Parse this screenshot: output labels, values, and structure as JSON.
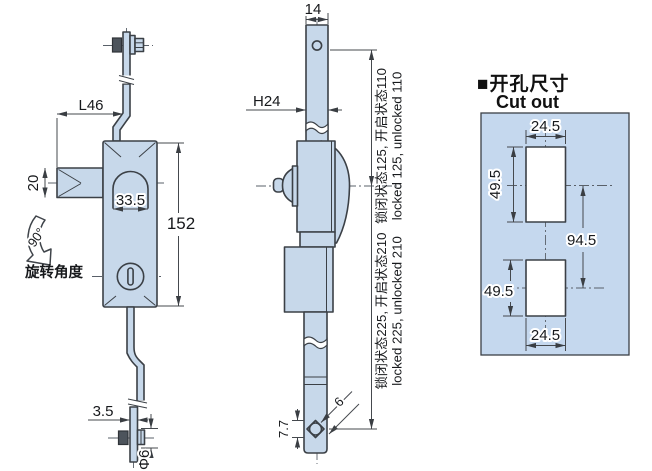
{
  "colors": {
    "part_fill": "#c7d8ea",
    "panel_fill": "#c5d8ee",
    "outline": "#3b4046",
    "dimension": "#45494e",
    "text": "#17191c"
  },
  "left_view": {
    "dims": {
      "rod_to_edge": "L46",
      "handle_thickness": "20",
      "slot_width": "33.5",
      "body_height": "152",
      "rod_thickness": "3.5",
      "bolt_diameter": "Φ6"
    },
    "rotation_angle": "90°",
    "rotation_label": "旋转角度"
  },
  "middle_view": {
    "dims": {
      "rod_top_width": "14",
      "rod_width": "H24",
      "bottom_hole_height": "7.7",
      "bottom_hole_side": "6"
    },
    "upper_stroke_zh": "锁闭状态125, 开启状态110",
    "upper_stroke_en": "locked 125, unlocked 110",
    "total_stroke_zh": "锁闭状态225, 开启状态210",
    "total_stroke_en": "locked 225, unlocked 210"
  },
  "cutout_view": {
    "heading_zh": "■开孔尺寸",
    "heading_en": "Cut out",
    "dims": {
      "top_width": "24.5",
      "top_height": "49.5",
      "hole_spacing": "94.5",
      "bottom_height": "49.5",
      "bottom_width": "24.5"
    }
  }
}
